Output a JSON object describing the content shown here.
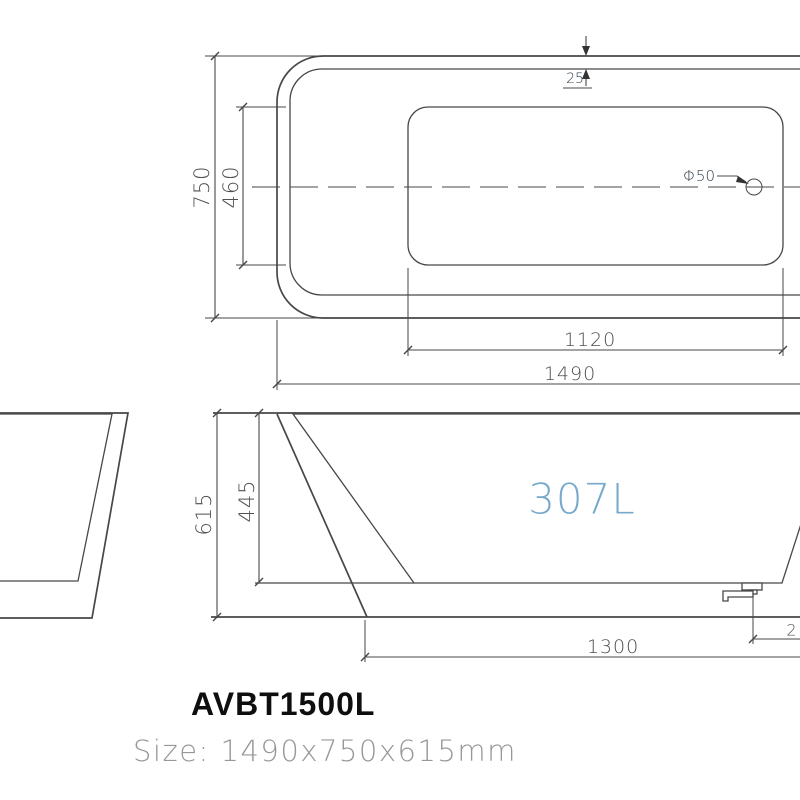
{
  "drawing": {
    "model": "AVBT1500L",
    "size_label": "Size: 1490x750x615mm",
    "capacity_label": "307L",
    "top_view": {
      "overall_length": "1490",
      "overall_width": "750",
      "inner_length": "1120",
      "inner_width": "460",
      "rim_width": "25",
      "drain_label": "Φ50"
    },
    "side_view": {
      "overall_height": "615",
      "inner_depth": "445",
      "base_length": "1300",
      "edge_offset_partial": "2"
    },
    "colors": {
      "tub_fill": "#A4DEF6",
      "drain_dot": "#2433CC",
      "capacity_text": "#76A9CB"
    }
  }
}
